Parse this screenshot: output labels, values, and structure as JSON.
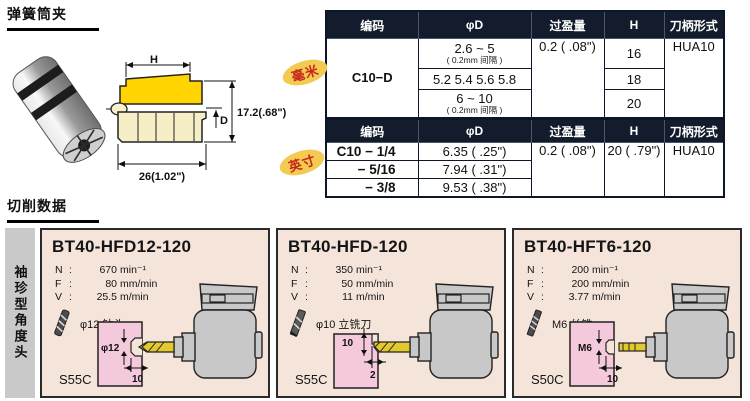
{
  "sections": {
    "collet_title": "弹簧筒夹",
    "cutting_title": "切削数据",
    "sidebar_label": "袖珍型角度头"
  },
  "punct": {
    "colon": ":"
  },
  "drawing": {
    "h_label": "H",
    "d_label": "D",
    "height_label": "17.2(.68\")",
    "width_label": "26(1.02\")"
  },
  "mm_table": {
    "badge": "毫米",
    "headers": [
      "编码",
      "φD",
      "过盈量",
      "H",
      "刀柄形式"
    ],
    "code": "C10−D",
    "rows": [
      {
        "d_main": "2.6 ~ 5",
        "d_sub": "( 0.2mm 间隔 )",
        "h": "16"
      },
      {
        "d_main": "5.2 5.4 5.6 5.8",
        "d_sub": "",
        "h": "18"
      },
      {
        "d_main": "6 ~ 10",
        "d_sub": "( 0.2mm 间隔 )",
        "h": "20"
      }
    ],
    "interference": "0.2 ( .08\")",
    "shank": "HUA10"
  },
  "inch_table": {
    "badge": "英寸",
    "headers": [
      "编码",
      "φD",
      "过盈量",
      "H",
      "刀柄形式"
    ],
    "rows": [
      {
        "code": "C10 − 1/4",
        "d": "6.35 ( .25\")"
      },
      {
        "code": "− 5/16",
        "d": "7.94 ( .31\")"
      },
      {
        "code": "− 3/8",
        "d": "9.53 ( .38\")"
      }
    ],
    "interference": "0.2 ( .08\")",
    "h": "20 ( .79\")",
    "shank": "HUA10"
  },
  "panels": [
    {
      "title": "BT40-HFD12-120",
      "nfv": [
        {
          "k": "N",
          "v": "670",
          "u": "min⁻¹"
        },
        {
          "k": "F",
          "v": "80",
          "u": "mm/min"
        },
        {
          "k": "V",
          "v": "25.5",
          "u": "m/min"
        }
      ],
      "tool": "φ12 钻头",
      "material": "S55C",
      "dim_a": "φ12",
      "dim_b": "10"
    },
    {
      "title": "BT40-HFD-120",
      "nfv": [
        {
          "k": "N",
          "v": "350",
          "u": "min⁻¹"
        },
        {
          "k": "F",
          "v": "50",
          "u": "mm/min"
        },
        {
          "k": "V",
          "v": "11",
          "u": "m/min"
        }
      ],
      "tool": "φ10 立铣刀",
      "material": "S55C",
      "dim_a": "10",
      "dim_b": "2"
    },
    {
      "title": "BT40-HFT6-120",
      "nfv": [
        {
          "k": "N",
          "v": "200",
          "u": "min⁻¹"
        },
        {
          "k": "F",
          "v": "200",
          "u": "mm/min"
        },
        {
          "k": "V",
          "v": "3.77",
          "u": "m/min"
        }
      ],
      "tool": "M6 丝锥",
      "material": "S50C",
      "dim_a": "M6",
      "dim_b": "10"
    }
  ]
}
